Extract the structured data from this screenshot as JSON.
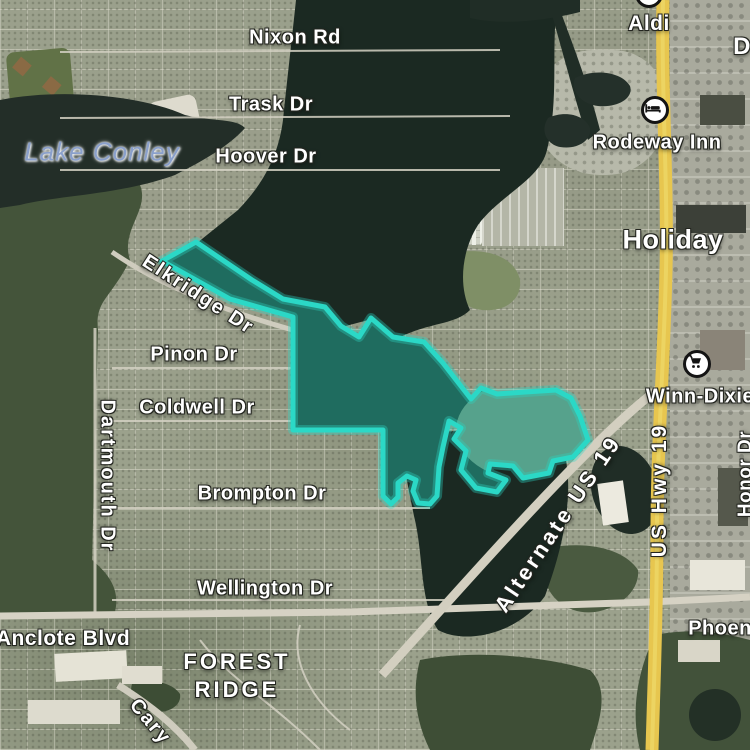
{
  "labels": {
    "nixon_rd": "Nixon Rd",
    "trask_dr": "Trask Dr",
    "hoover_dr": "Hoover Dr",
    "lake_conley": "Lake Conley",
    "aldi": "Aldi",
    "rodeway_inn": "Rodeway Inn",
    "holiday": "Holiday",
    "winn_dixie": "Winn-Dixie",
    "elkridge_dr": "Elkridge Dr",
    "pinon_dr": "Pinon Dr",
    "coldwell_dr": "Coldwell Dr",
    "dartmouth_dr": "Dartmouth Dr",
    "brompton_dr": "Brompton Dr",
    "wellington_dr": "Wellington Dr",
    "anclote_blvd": "Anclote Blvd",
    "forest_ridge_line1": "FOREST",
    "forest_ridge_line2": "RIDGE",
    "alternate_us_19": "Alternate US 19",
    "us_hwy_19": "US Hwy 19",
    "honor_dr": "Honor Dr",
    "phoenix_partial": "Phoen",
    "cary": "Cary",
    "d_partial": "D"
  },
  "poi_icons": {
    "rodeway_inn": "bed-icon",
    "winn_dixie": "shopping-cart-icon",
    "aldi": "store-circle-icon-partial"
  },
  "selection": {
    "path": "M162,261 L196,242 L252,280 L283,299 L325,307 L341,326 L359,337 L371,318 L393,337 L424,342 L443,363 L464,390 L471,399 L481,388 L497,394 L525,392 L556,390 L571,398 L580,416 L588,440 L573,457 L553,461 L549,473 L523,478 L513,466 L490,464 L488,473 L506,480 L497,492 L476,488 L461,470 L466,451 L454,439 L461,428 L449,421 L443,447 L439,467 L437,496 L430,504 L418,503 L413,491 L416,480 L407,476 L398,483 L398,497 L391,504 L383,496 L383,430 L293,430 L293,317 L230,299 L196,280 Z",
    "stroke_color": "#2bd8c6",
    "fill_color": "rgba(44,206,186,0.42)"
  },
  "colors": {
    "highway_yellow": "#e7c64f",
    "water_dark": "#1b2922",
    "forest_green": "#44543a",
    "water_label_blue": "#8aa0cb",
    "label_halo": "#23251f"
  }
}
